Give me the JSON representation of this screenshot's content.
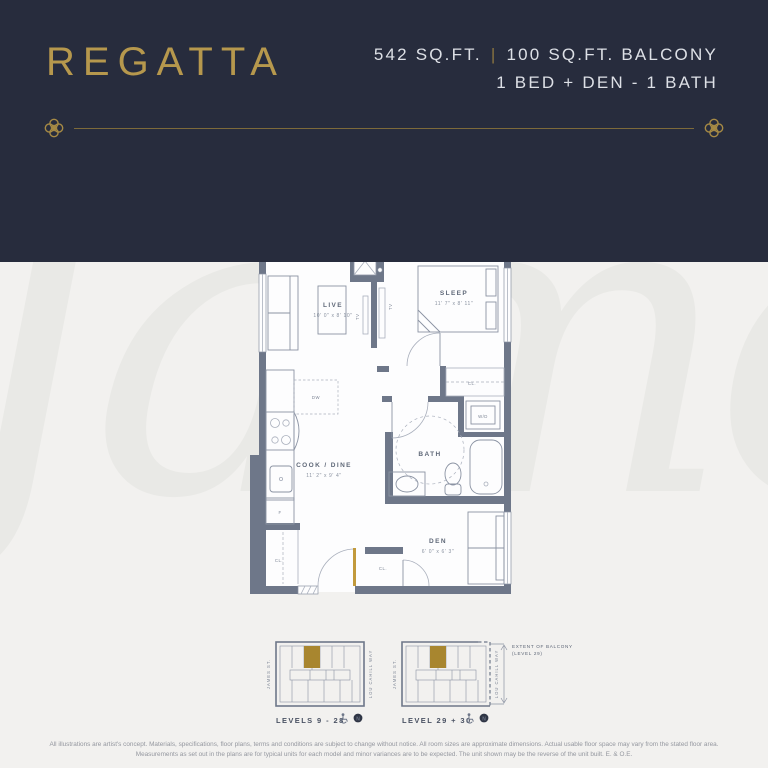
{
  "header": {
    "brand": "REGATTA",
    "area": "542 SQ.FT.",
    "divider": "|",
    "balcony_area": "100 SQ.FT. BALCONY",
    "config": "1 BED + DEN - 1 BATH"
  },
  "watermark": "James",
  "colors": {
    "navy": "#272c3d",
    "gold": "#b6984d",
    "wall_gray": "#6e7789",
    "unit_gold": "#a8862f",
    "door_gold": "#c29a3c",
    "background": "#f2f1ef"
  },
  "floorplan": {
    "balcony": {
      "label": "BALCONY",
      "area": "100 SQ. FT"
    },
    "live": {
      "name": "LIVE",
      "dims": "10' 0\" x 8' 10\""
    },
    "sleep": {
      "name": "SLEEP",
      "dims": "11' 7\" x 8' 11\""
    },
    "cook_dine": {
      "name": "COOK / DINE",
      "dims": "11' 2\" x 9' 4\""
    },
    "bath": {
      "name": "BATH"
    },
    "den": {
      "name": "DEN",
      "dims": "6' 0\" x 6' 3\""
    },
    "labels": {
      "wd": "W/D",
      "cl": "CL.",
      "tv": "TV",
      "dw": "DW",
      "fridge": "F"
    }
  },
  "keyplans": {
    "left": {
      "caption": "LEVELS 9 - 28"
    },
    "right": {
      "caption": "LEVEL 29 + 30"
    },
    "street_left": "JAMES ST.",
    "street_right": "LOU CAHILL WAY",
    "extent_note_line1": "EXTENT OF BALCONY",
    "extent_note_line2": "(LEVEL 29)",
    "compass": "N"
  },
  "disclaimer": {
    "line1": "All illustrations are artist's concept. Materials, specifications, floor plans, terms and conditions are subject to change without notice. All room sizes are approximate dimensions. Actual usable floor space may vary from the stated floor area.",
    "line2": "Measurements as set out in the plans are for typical units for each model and minor variances are to be expected. The unit shown may be the reverse of the unit built. E. & O.E."
  }
}
